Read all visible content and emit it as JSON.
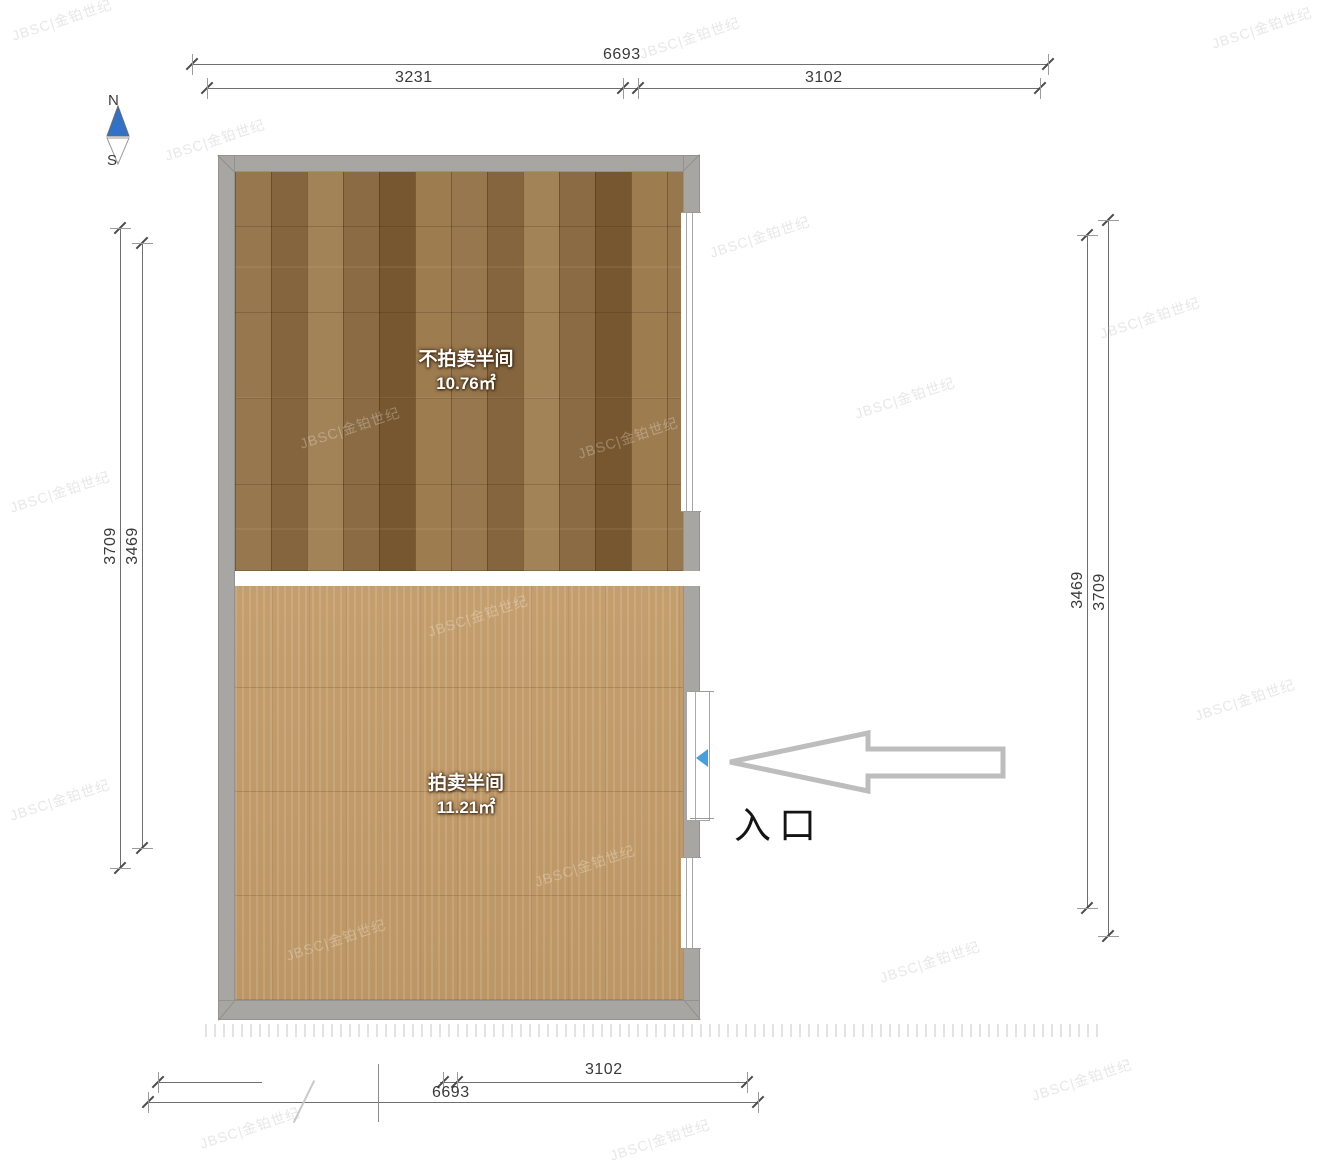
{
  "compass": {
    "north": "N",
    "south": "S"
  },
  "dimensions": {
    "top_total": "6693",
    "top_left_segment": "3231",
    "top_right_segment": "3102",
    "left_outer": "3709",
    "left_inner": "3469",
    "right_inner": "3469",
    "right_outer": "3709",
    "bottom_segment": "3102",
    "bottom_total": "6693"
  },
  "rooms": {
    "top": {
      "name": "不拍卖半间",
      "area": "10.76㎡"
    },
    "bottom": {
      "name": "拍卖半间",
      "area": "11.21㎡"
    }
  },
  "entrance": {
    "label": "入口"
  },
  "watermark": {
    "text": "JBSC|金铂世纪",
    "positions": [
      {
        "x": 62,
        "y": 20,
        "on": "paper"
      },
      {
        "x": 690,
        "y": 38,
        "on": "paper"
      },
      {
        "x": 1262,
        "y": 28,
        "on": "paper"
      },
      {
        "x": 215,
        "y": 140,
        "on": "paper"
      },
      {
        "x": 760,
        "y": 237,
        "on": "paper"
      },
      {
        "x": 1150,
        "y": 318,
        "on": "paper"
      },
      {
        "x": 905,
        "y": 398,
        "on": "paper"
      },
      {
        "x": 60,
        "y": 492,
        "on": "paper"
      },
      {
        "x": 60,
        "y": 800,
        "on": "paper"
      },
      {
        "x": 1245,
        "y": 700,
        "on": "paper"
      },
      {
        "x": 930,
        "y": 962,
        "on": "paper"
      },
      {
        "x": 1082,
        "y": 1080,
        "on": "paper"
      },
      {
        "x": 250,
        "y": 1128,
        "on": "paper"
      },
      {
        "x": 660,
        "y": 1140,
        "on": "paper"
      },
      {
        "x": 350,
        "y": 428,
        "on": "wood"
      },
      {
        "x": 628,
        "y": 438,
        "on": "wood"
      },
      {
        "x": 478,
        "y": 616,
        "on": "wood"
      },
      {
        "x": 336,
        "y": 940,
        "on": "wood"
      },
      {
        "x": 585,
        "y": 866,
        "on": "wood"
      }
    ]
  },
  "colors": {
    "wall": "#a8a6a3",
    "floor_dark_wood": "#8a6b45",
    "floor_light_wood": "#c19a69",
    "door_marker_blue": "#46a0dd",
    "compass_north_blue": "#2f72c8",
    "arrow_outline": "#bdbdbd",
    "dimension_line": "#6f6f6f"
  }
}
